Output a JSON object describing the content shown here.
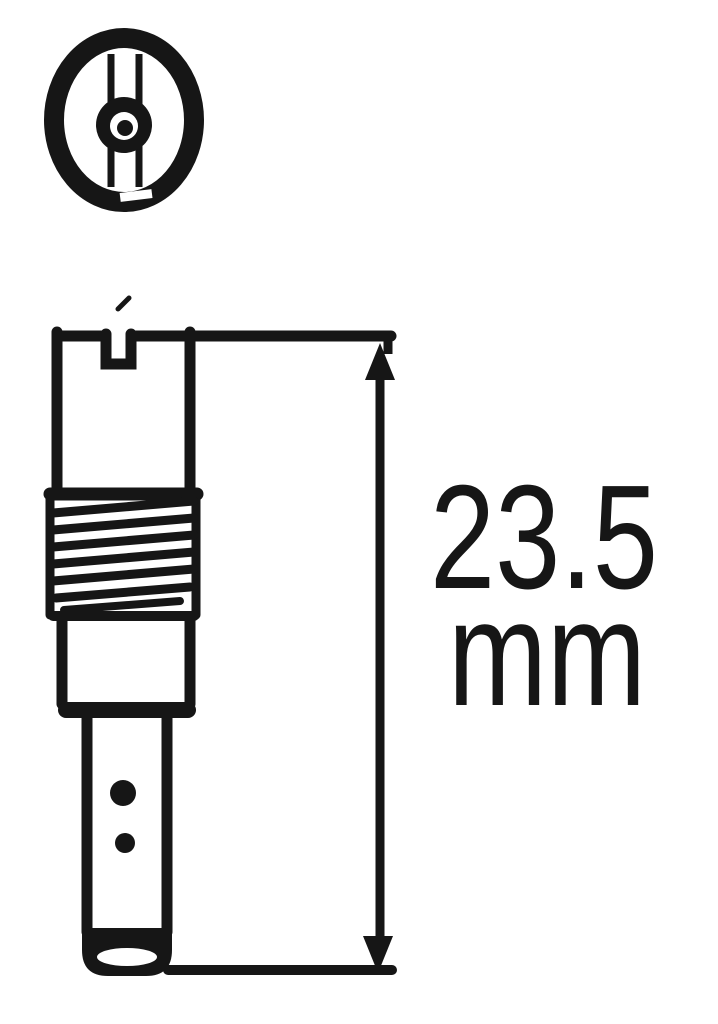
{
  "drawing": {
    "type": "technical-line-drawing",
    "background_color": "#ffffff",
    "ink_color": "#161616",
    "dimension": {
      "value": "23.5",
      "unit": "mm",
      "full_label": "23.5 mm"
    }
  }
}
